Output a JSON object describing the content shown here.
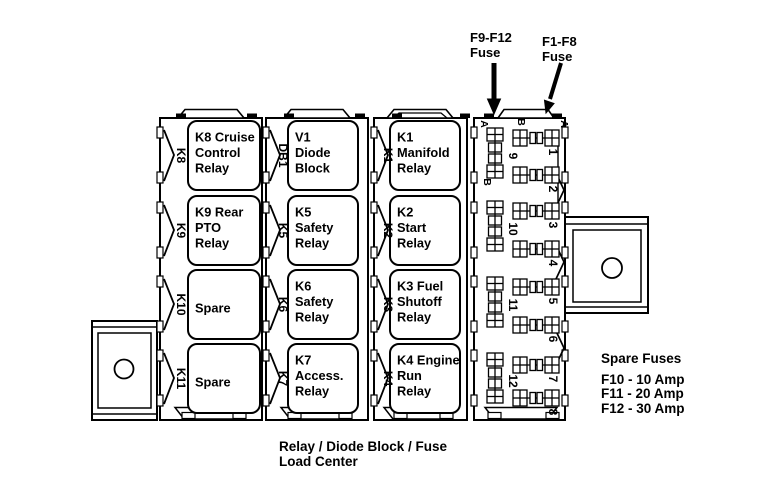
{
  "diagram": {
    "caption": {
      "line1": "Relay / Diode Block / Fuse",
      "line2": "Load Center"
    },
    "annotations": {
      "f9_f12": {
        "line1": "F9-F12",
        "line2": "Fuse"
      },
      "f1_f8": {
        "line1": "F1-F8",
        "line2": "Fuse"
      }
    },
    "spare_fuses": {
      "title": "Spare Fuses",
      "items": [
        "F10 - 10 Amp",
        "F11 - 20 Amp",
        "F12 - 30 Amp"
      ]
    },
    "columns": [
      {
        "slots": [
          {
            "designator": "K8",
            "lines": [
              "K8 Cruise",
              "Control",
              "Relay"
            ]
          },
          {
            "designator": "K9",
            "lines": [
              "K9 Rear",
              "PTO",
              "Relay"
            ]
          },
          {
            "designator": "K10",
            "lines": [
              "Spare"
            ]
          },
          {
            "designator": "K11",
            "lines": [
              "Spare"
            ]
          }
        ]
      },
      {
        "slots": [
          {
            "designator": "DB1",
            "lines": [
              "V1",
              "Diode",
              "Block"
            ]
          },
          {
            "designator": "K5",
            "lines": [
              "K5",
              "Safety",
              "Relay"
            ]
          },
          {
            "designator": "K6",
            "lines": [
              "K6",
              "Safety",
              "Relay"
            ]
          },
          {
            "designator": "K7",
            "lines": [
              "K7",
              "Access.",
              "Relay"
            ]
          }
        ]
      },
      {
        "slots": [
          {
            "designator": "K1",
            "lines": [
              "K1",
              "Manifold",
              "Relay"
            ]
          },
          {
            "designator": "K2",
            "lines": [
              "K2",
              "Start",
              "Relay"
            ]
          },
          {
            "designator": "K3",
            "lines": [
              "K3 Fuel",
              "Shutoff",
              "Relay"
            ]
          },
          {
            "designator": "K4",
            "lines": [
              "K4 Engine",
              "Run",
              "Relay"
            ]
          }
        ]
      }
    ],
    "fuse_panel": {
      "vertical_fuses": [
        "9",
        "10",
        "11",
        "12"
      ],
      "vertical_terminal_labels": [
        "A",
        "B"
      ],
      "horizontal_fuses": [
        "1",
        "2",
        "3",
        "4",
        "5",
        "6",
        "7",
        "8"
      ],
      "horizontal_terminal_labels": [
        "B",
        "A"
      ]
    },
    "colors": {
      "ink": "#000000",
      "paper": "#ffffff"
    }
  }
}
